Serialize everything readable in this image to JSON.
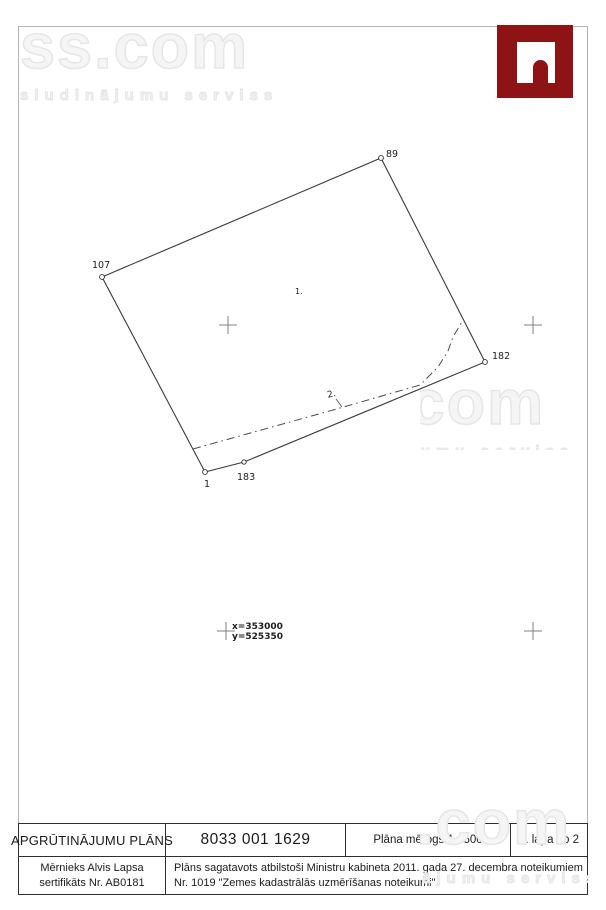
{
  "watermark": {
    "brand": "ss.com",
    "tagline": "sludinājumu serviss"
  },
  "logo": {
    "name": "ss-arch-logo",
    "color": "#8e1314"
  },
  "plan": {
    "points": [
      {
        "label": "89"
      },
      {
        "label": "107"
      },
      {
        "label": "1"
      },
      {
        "label": "183"
      },
      {
        "label": "182"
      }
    ],
    "area_label": "1.",
    "encumbrance_label": "2.",
    "coords": {
      "x": "x=353000",
      "y": "y=525350"
    }
  },
  "title_block": {
    "title": "APGRŪTINĀJUMU PLĀNS",
    "cadastre_number": "8033 001 1629",
    "scale_label": "Plāna mērogs 1 : 500",
    "page_label": "2. lapa no 2",
    "surveyor": {
      "line1": "Mērnieks Alvis Lapsa",
      "line2": "sertifikāts Nr. AB0181"
    },
    "regulation": {
      "line1": "Plāns sagatavots atbilstoši Ministru kabineta 2011. gada 27. decembra noteikumiem",
      "line2": "Nr. 1019 \"Zemes kadastrālās uzmērīšanas noteikumi\""
    }
  }
}
